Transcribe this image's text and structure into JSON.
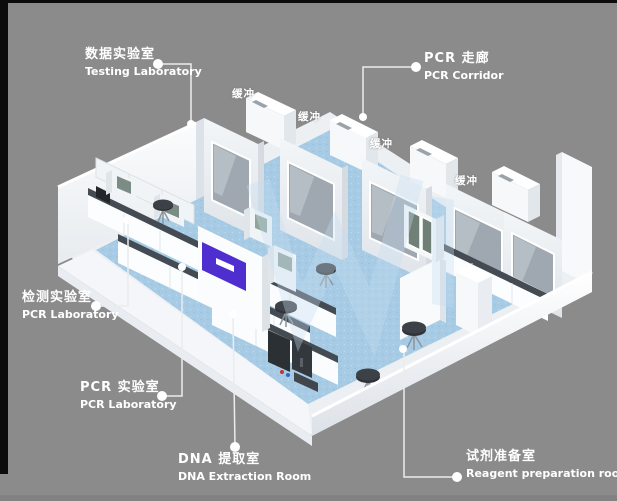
{
  "scene": {
    "buffer_label": "缓冲",
    "labels": {
      "testing_lab": {
        "zh": "数据实验室",
        "en": "Testing Laboratory"
      },
      "pcr_corridor": {
        "zh": "PCR 走廊",
        "en": "PCR Corridor"
      },
      "detection_lab": {
        "zh": "检测实验室",
        "en": "PCR Laboratory"
      },
      "pcr_lab": {
        "zh": "PCR 实验室",
        "en": "PCR Laboratory"
      },
      "dna_room": {
        "zh": "DNA 提取室",
        "en": "DNA Extraction Room"
      },
      "reagent_room": {
        "zh": "试剂准备室",
        "en": "Reagent preparation room"
      }
    },
    "colors": {
      "background": "#8b8b8b",
      "floor_blue": "#a7cbe4",
      "wall_white": "#f4f6f8",
      "counter_dark": "#454b52",
      "accent_purple": "#4f2ecf",
      "label_text": "#ffffff",
      "watermark_blue": "#c6def2"
    }
  }
}
